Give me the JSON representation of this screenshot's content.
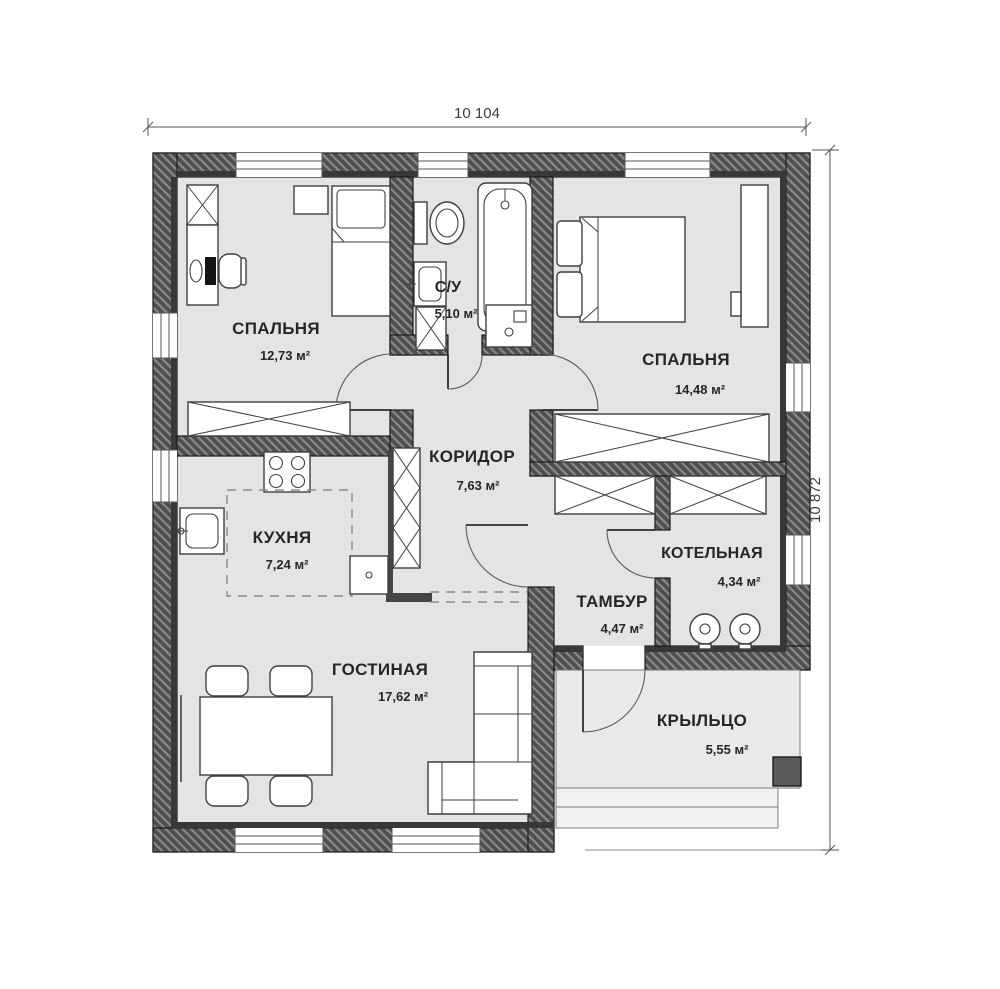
{
  "plan": {
    "dimensions": {
      "width": "10 104",
      "height": "10 872"
    },
    "rooms": [
      {
        "id": "bedroom-1",
        "name": "СПАЛЬНЯ",
        "area": "12,73 м²"
      },
      {
        "id": "bathroom",
        "name": "С/У",
        "area": "5,10 м²"
      },
      {
        "id": "bedroom-2",
        "name": "СПАЛЬНЯ",
        "area": "14,48 м²"
      },
      {
        "id": "corridor",
        "name": "КОРИДОР",
        "area": "7,63 м²"
      },
      {
        "id": "kitchen",
        "name": "КУХНЯ",
        "area": "7,24 м²"
      },
      {
        "id": "boiler-room",
        "name": "КОТЕЛЬНАЯ",
        "area": "4,34 м²"
      },
      {
        "id": "vestibule",
        "name": "ТАМБУР",
        "area": "4,47 м²"
      },
      {
        "id": "living-room",
        "name": "ГОСТИНАЯ",
        "area": "17,62 м²"
      },
      {
        "id": "porch",
        "name": "КРЫЛЬЦО",
        "area": "5,55 м²"
      }
    ],
    "furniture": [
      "wardrobe",
      "desk",
      "office-chair",
      "monitor",
      "single-bed",
      "nightstand",
      "toilet",
      "bathroom-sink",
      "bathtub",
      "washing-machine",
      "double-bed",
      "dresser",
      "kitchen-stove",
      "kitchen-sink",
      "kitchen-counter",
      "fridge",
      "shelving",
      "dining-table",
      "chair",
      "corner-sofa",
      "boiler",
      "porch-steps",
      "porch-column"
    ],
    "colors": {
      "wall": "#4f4f4f",
      "wall_hatch": "#8b8b8b",
      "floor": "#e4e4e4",
      "outline": "#3f3f3f",
      "porch_floor": "#e9e9e9",
      "text": "#262626"
    }
  }
}
